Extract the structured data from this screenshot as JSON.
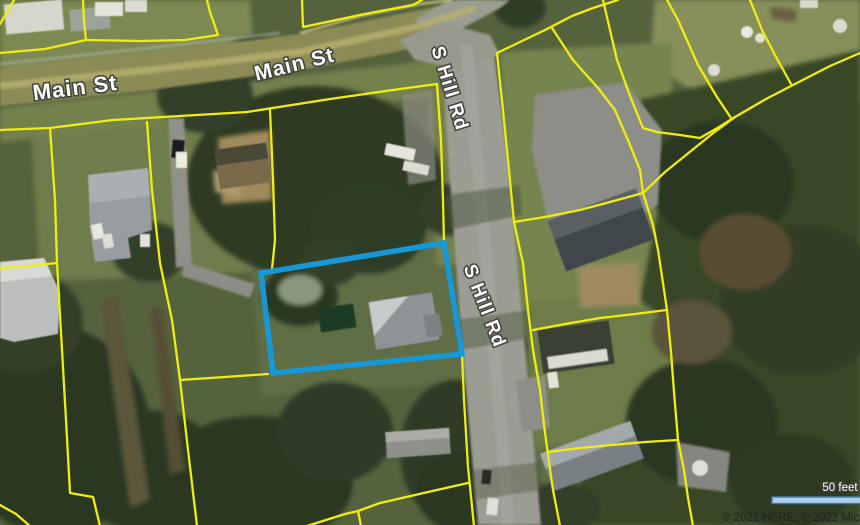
{
  "map_view": {
    "type": "aerial-parcel-map",
    "road_labels": {
      "main_st_west": "Main St",
      "main_st_east": "Main St",
      "s_hill_rd_north": "S Hill Rd",
      "s_hill_rd_south": "S Hill Rd"
    },
    "scale_bar": {
      "label": "50 feet",
      "fill": "#aecfe9",
      "border": "#4579ad"
    },
    "attribution": {
      "text": "© 2022 HERE, © 2022 Micro"
    },
    "colors": {
      "parcel_boundary": "#f1ec10",
      "selected_parcel": "#1697d6"
    }
  }
}
